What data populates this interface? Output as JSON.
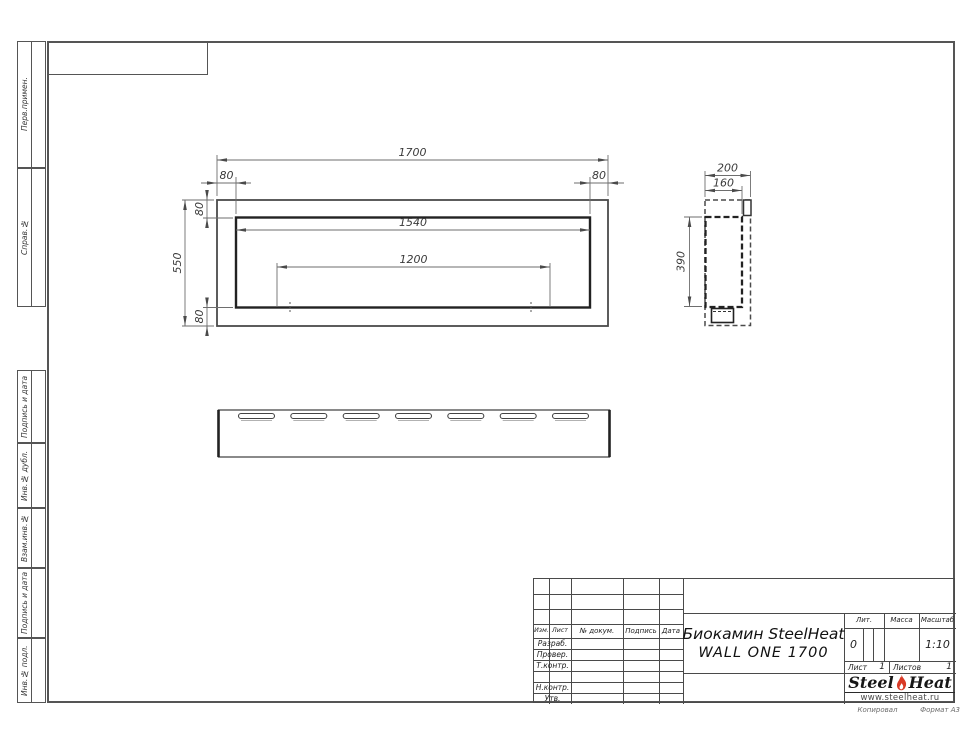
{
  "sheet": {
    "copied_label": "Копировал",
    "format_label": "Формат А3"
  },
  "margin_labels": [
    "Перв.примен.",
    "Справ.№",
    "Подпись и дата",
    "Инв.№ дубл.",
    "Взам.инв.№",
    "Подпись и дата",
    "Инв.№ подл."
  ],
  "front_view": {
    "total_width": "1700",
    "frame_left": "80",
    "frame_right": "80",
    "frame_top": "80",
    "total_height": "550",
    "frame_bottom": "80",
    "opening_width": "1540",
    "burner_width": "1200"
  },
  "side_view": {
    "total_depth": "200",
    "inner_depth": "160",
    "inner_height": "390"
  },
  "title_block": {
    "columns": [
      "Изм.",
      "Лист",
      "№ докум.",
      "Подпись",
      "Дата"
    ],
    "rows": [
      "Разраб.",
      "Провер.",
      "Т.контр.",
      "",
      "Н.контр.",
      "Утв."
    ],
    "title_line1": "Биокамин SteelHeat",
    "title_line2": "WALL ONE 1700",
    "lit_label": "Лит.",
    "lit_value": "0",
    "mass_label": "Масса",
    "scale_label": "Масштаб",
    "scale_value": "1:10",
    "sheet_label": "Лист",
    "sheet_number": "1",
    "sheets_label": "Листов",
    "sheets_total": "1",
    "logo": {
      "word1": "Steel",
      "word2": "Heat",
      "url": "www.steelheat.ru"
    }
  },
  "colors": {
    "frame_line": "#555555",
    "object_line": "#222222",
    "thin_line": "#6e6e6e",
    "flame_red": "#d93a26"
  }
}
